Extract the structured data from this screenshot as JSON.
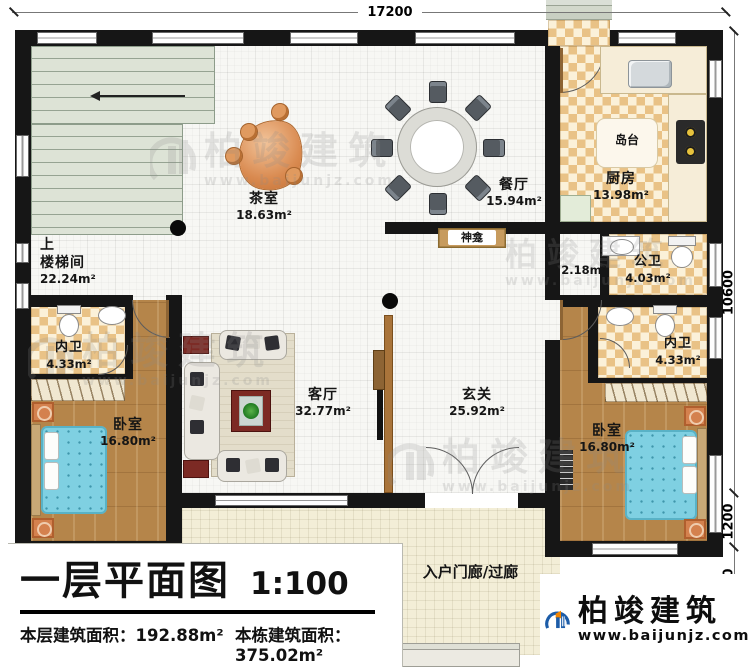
{
  "dimensions": {
    "top": "17200",
    "right": [
      "10600",
      "1200",
      "2100"
    ]
  },
  "rooms": {
    "stair": {
      "direction": "上",
      "name": "楼梯间",
      "area": "22.24m²"
    },
    "tea": {
      "name": "茶室",
      "area": "18.63m²"
    },
    "dining": {
      "name": "餐厅",
      "area": "15.94m²"
    },
    "kitchen": {
      "name": "厨房",
      "area": "13.98m²"
    },
    "island": {
      "name": "岛台"
    },
    "shrine": {
      "name": "神龛"
    },
    "public_bath": {
      "name": "公卫",
      "area": "4.03m²"
    },
    "bath_lobby": {
      "area": "2.18m²"
    },
    "ensuite_left": {
      "name": "内卫",
      "area": "4.33m²"
    },
    "ensuite_right": {
      "name": "内卫",
      "area": "4.33m²"
    },
    "bedroom_left": {
      "name": "卧室",
      "area": "16.80m²"
    },
    "bedroom_right": {
      "name": "卧室",
      "area": "16.80m²"
    },
    "living": {
      "name": "客厅",
      "area": "32.77m²"
    },
    "foyer": {
      "name": "玄关",
      "area": "25.92m²"
    },
    "porch": {
      "name": "入户门廊/过廊"
    }
  },
  "title_block": {
    "title": "一层平面图",
    "scale": "1:100",
    "stats": [
      {
        "label": "本层建筑面积：",
        "value": "192.88m²"
      },
      {
        "label": "本栋建筑面积：",
        "value": "375.02m²"
      },
      {
        "label": "占地面积：",
        "value": "229.53m²"
      },
      {
        "label": "层高：",
        "value": "3.9m"
      }
    ]
  },
  "brand": {
    "name": "柏竣建筑",
    "url": "www.baijunjz.com"
  },
  "watermark": {
    "name": "柏竣建筑",
    "url": "www.baijunjz.com"
  },
  "colors": {
    "wall": "#161616",
    "checker": "#e9c286",
    "wood": "#b5854a",
    "bed": "#7fd0e2",
    "stairs": "#dde3d6",
    "porch": "#f3eed7",
    "divider_wood": "#a9743a",
    "logo_blue": "#1c5ca8",
    "logo_orange": "#f08300"
  }
}
